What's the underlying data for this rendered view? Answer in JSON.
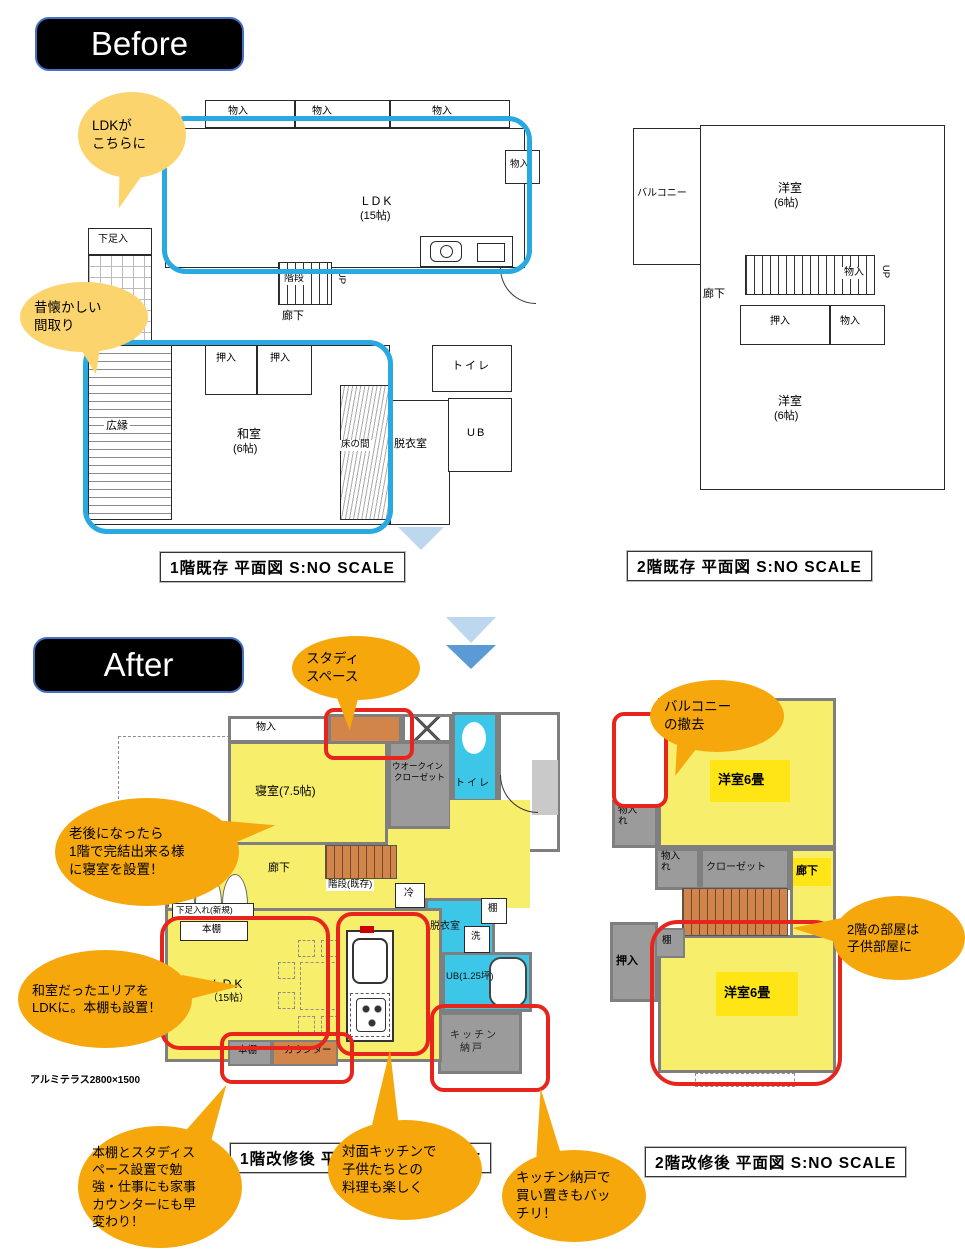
{
  "colors": {
    "highlight_blue": "#29A9E1",
    "highlight_red": "#E8251C",
    "bubble_light": "#FBD46D",
    "bubble_orange": "#F5A70B",
    "room_yellow": "#F7EE6C",
    "room_yellow_bright": "#FFE515",
    "room_cyan": "#3CC7E8",
    "room_gray": "#9B9B9B",
    "stair_orange": "#D2854A",
    "arrow_light": "#BDD7EE",
    "arrow_blue": "#5B9BD5"
  },
  "before": {
    "tag": "Before",
    "bubble_ldk": {
      "l1": "LDKが",
      "l2": "こちらに"
    },
    "bubble_natsukashii": {
      "l1": "昔懐かしい",
      "l2": "間取り"
    },
    "f1": {
      "caption": "1階既存 平面図 S:NO SCALE",
      "closet1": "物入",
      "closet2": "物入",
      "closet3": "物入",
      "closet_r": "物入",
      "ldk": "LDK",
      "ldk_size": "(15帖)",
      "shoe": "下足入",
      "stairs": "階段",
      "up": "UP",
      "hall": "廊下",
      "oshiire1": "押入",
      "oshiire2": "押入",
      "hiroen": "広縁",
      "washitsu": "和室",
      "washitsu_size": "(6帖)",
      "tokonoma": "床の間",
      "datsui": "脱衣室",
      "toilet": "トイレ",
      "ub": "UB"
    },
    "f2": {
      "caption": "2階既存 平面図 S:NO SCALE",
      "balcony": "バルコニー",
      "room_top": "洋室",
      "room_top_size": "(6帖)",
      "hall": "廊下",
      "closet_up": "物入",
      "up": "UP",
      "oshiire": "押入",
      "closet": "物入",
      "room_bottom": "洋室",
      "room_bottom_size": "(6帖)"
    }
  },
  "after": {
    "tag": "After",
    "bubble_study": {
      "l1": "スタディ",
      "l2": "スペース"
    },
    "bubble_rougo": {
      "l1": "老後になったら",
      "l2": "1階で完結出来る様",
      "l3": "に寝室を設置！"
    },
    "bubble_washitsu": {
      "l1": "和室だったエリアを",
      "l2": "LDKに。本棚も設置！"
    },
    "bubble_balcony": {
      "l1": "バルコニー",
      "l2": "の撤去"
    },
    "bubble_kodomo": {
      "l1": "2階の部屋は",
      "l2": "子供部屋に"
    },
    "bubble_hondana": {
      "l1": "本棚とスタディス",
      "l2": "ペース設置で勉",
      "l3": "強・仕事にも家事",
      "l4": "カウンターにも早",
      "l5": "変わり！"
    },
    "bubble_taimen": {
      "l1": "対面キッチンで",
      "l2": "子供たちとの",
      "l3": "料理も楽しく"
    },
    "bubble_pantry": {
      "l1": "キッチン納戸で",
      "l2": "買い置きもバッ",
      "l3": "チリ！"
    },
    "f1": {
      "caption": "1階改修後 平面図 S:NO SCALE",
      "closet": "物入",
      "bedroom": "寝室(7.5帖)",
      "wic1": "ウオークイン",
      "wic2": "クローゼット",
      "toilet": "トイレ",
      "hall": "廊下",
      "stairs": "階段(既存)",
      "fridge": "冷",
      "datsui": "脱衣室",
      "tana": "棚",
      "sen": "洗",
      "ub": "UB(1.25坪)",
      "pantry1": "キッチン",
      "pantry2": "納戸",
      "ldk": "LDK",
      "ldk_size": "（15帖）",
      "shoe": "下足入れ(新規)",
      "bookshelf_top": "本棚",
      "bookshelf_bottom": "本棚",
      "counter": "カウンター",
      "terrace": "アルミテラス2800×1500"
    },
    "f2": {
      "caption": "2階改修後 平面図 S:NO SCALE",
      "room_top": "洋室6畳",
      "monoire1": "物入れ",
      "monoire2": "物入れ",
      "closet": "クローゼット",
      "hall": "廊下",
      "tana": "棚",
      "oshiire": "押入",
      "room_bottom": "洋室6畳"
    }
  }
}
